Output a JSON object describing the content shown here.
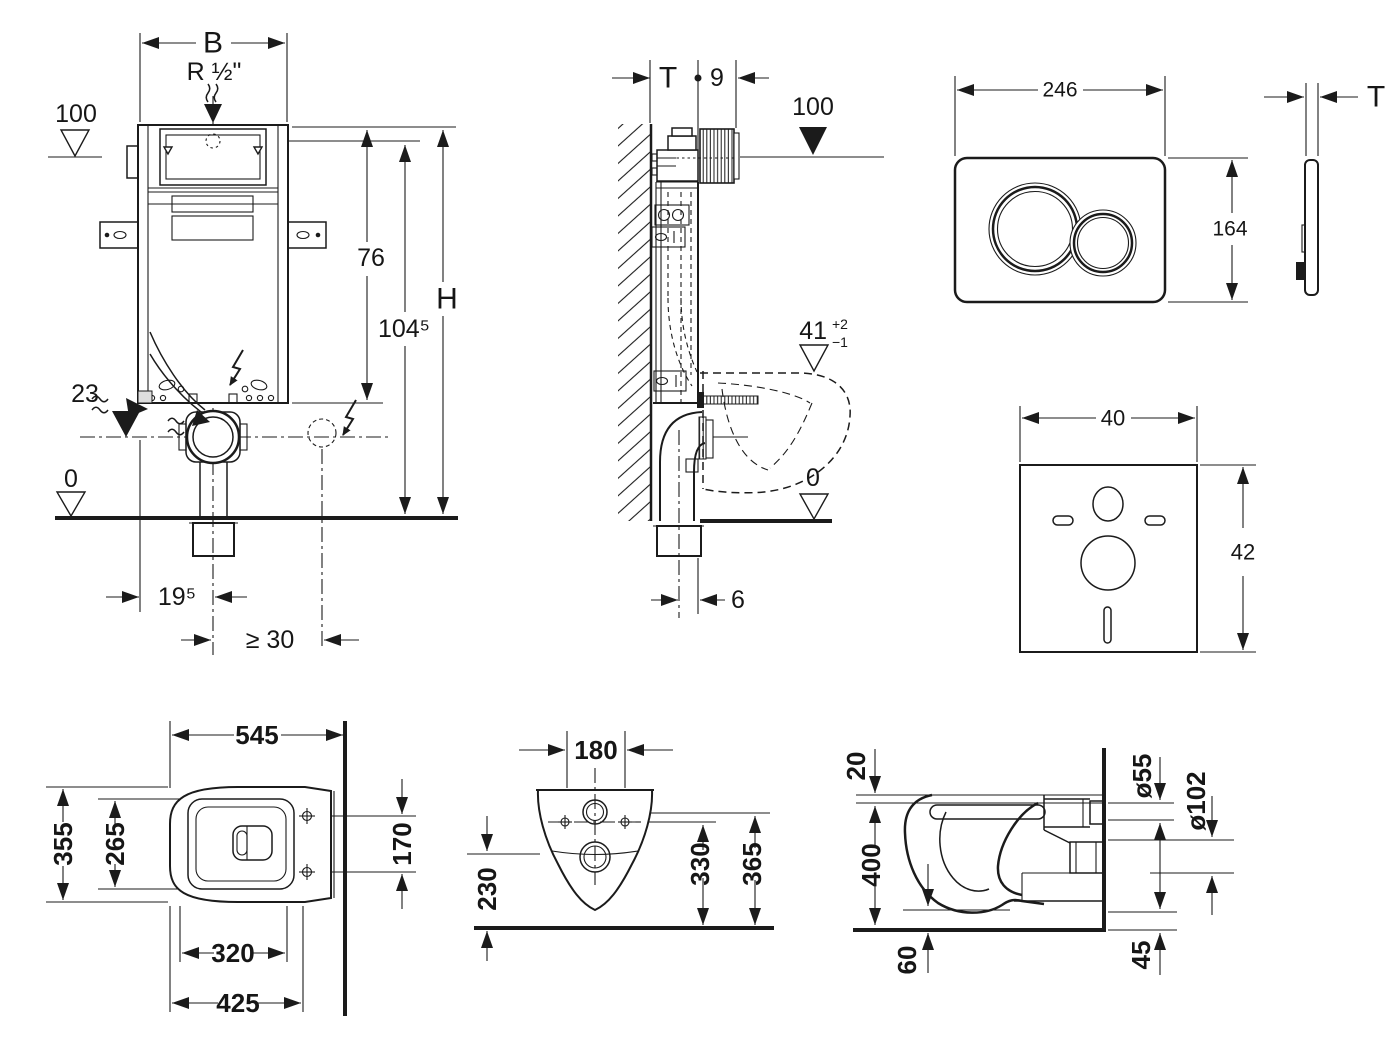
{
  "drawing": {
    "frame_front": {
      "width": "B",
      "inlet": "R ½\"",
      "level_top": "100",
      "height_cistern": "76",
      "height_total": "104⁵",
      "height_h": "H",
      "service_opening": "18/23",
      "offset_left": "5",
      "offset_right": "5",
      "level_drain": "23",
      "level_floor": "0",
      "drain_offset": "19⁵",
      "elec_offset": "≥ 30"
    },
    "frame_side": {
      "wall_thickness": "T",
      "front_depth": "9",
      "level_top": "100",
      "pan_height": "41",
      "pan_height_tol_plus": "+2",
      "pan_height_tol_minus": "−1",
      "level_floor": "0",
      "drain_center_offset": "6"
    },
    "flush_plate": {
      "width": "246",
      "height": "164",
      "thickness": "T"
    },
    "sound_pad": {
      "width": "40",
      "height": "42"
    },
    "pan_top": {
      "depth": "545",
      "width": "355",
      "inner_width": "265",
      "hinge_distance": "170",
      "fixing_width": "320",
      "rim_width": "425"
    },
    "pan_rear": {
      "hole_distance": "180",
      "height_rim": "230",
      "height_mid": "330",
      "height_top": "365"
    },
    "pan_side": {
      "seat_thickness": "20",
      "mount_height": "400",
      "clearance": "60",
      "flush_pipe_dia": "ø55",
      "drain_pipe_dia": "ø102",
      "drain_height": "45"
    }
  },
  "icons": {
    "water_flow": "wave-arrow",
    "electric": "lightning-bolt",
    "level_filled": "filled-triangle-down",
    "level_open": "open-triangle-down"
  }
}
